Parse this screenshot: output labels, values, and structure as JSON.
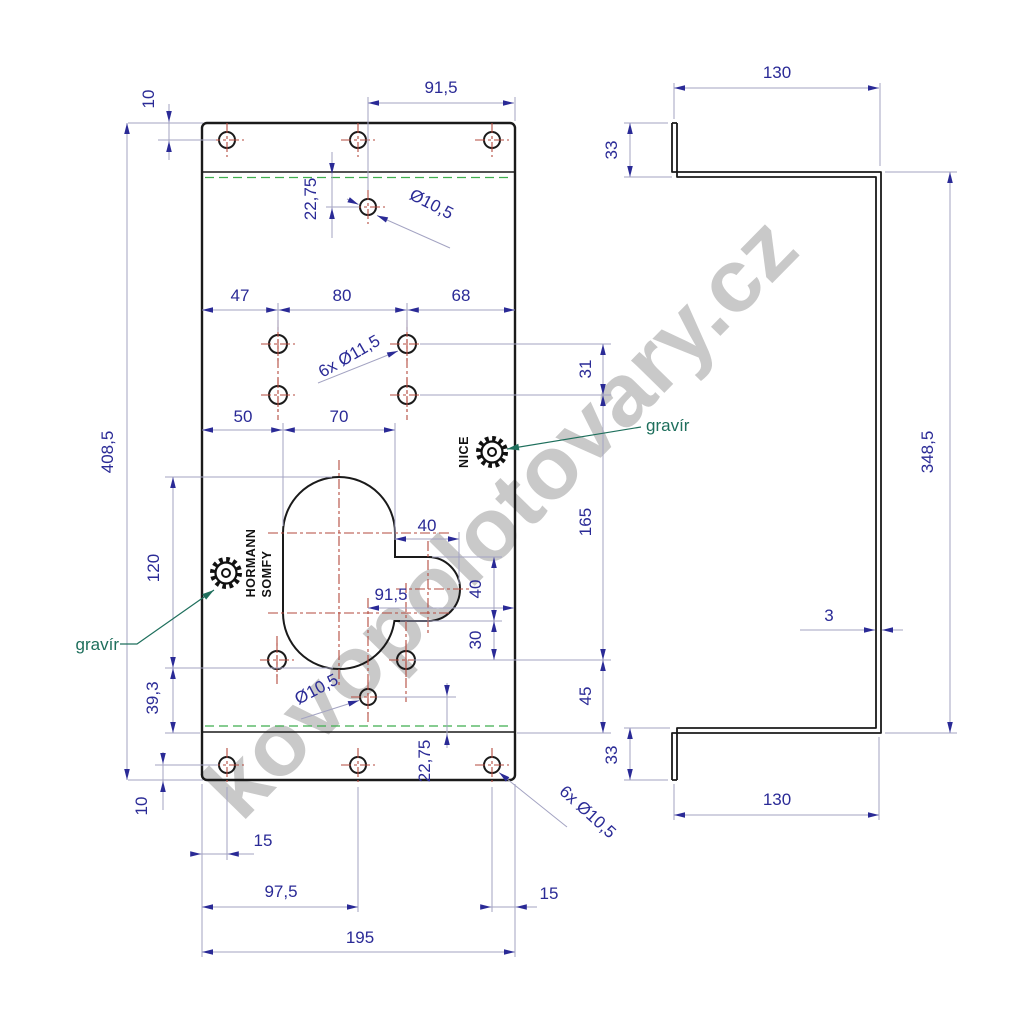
{
  "watermark": {
    "text": "kovopolotovary.cz"
  },
  "colors": {
    "dim": "#2a2a96",
    "line": "#a3a3c2",
    "outline": "#1a1a1a",
    "centerline": "#b34a3e",
    "bend": "#3fae4e",
    "engrave": "#1e6f5c",
    "watermark": "#c9c9c9"
  },
  "front_view": {
    "dims": {
      "top_offset": "10",
      "top_hole_to_edge": "91,5",
      "fold_to_hole_top": "22,75",
      "hole_dia_top": "Ø10,5",
      "col_left": "47",
      "col_mid": "80",
      "col_right": "68",
      "grid_dia": "6x Ø11,5",
      "grid_row_gap": "31",
      "key_left": "50",
      "key_width": "70",
      "total_height": "408,5",
      "key_height": "120",
      "slot_width": "40",
      "slot_pos": "91,5",
      "slot_height": "40",
      "slot_to_holes": "30",
      "mid_span": "165",
      "bottom_span": "45",
      "key_to_fold": "39,3",
      "hole_dia_bottom": "Ø10,5",
      "fold_to_hole_bottom": "22,75",
      "bottom_offset": "10",
      "edge_left": "15",
      "bottom_mid": "97,5",
      "edge_right": "15",
      "total_width": "195",
      "corner_dia": "6x Ø10,5"
    },
    "labels": {
      "gravir_left": "gravír",
      "gravir_right": "gravír",
      "brand1": "HORMANN",
      "brand2": "SOMFY",
      "brand3": "NICE"
    }
  },
  "side_view": {
    "dims": {
      "flange_top": "130",
      "lip_top": "33",
      "web_height": "348,5",
      "thickness": "3",
      "lip_bottom": "33",
      "flange_bottom": "130"
    }
  }
}
